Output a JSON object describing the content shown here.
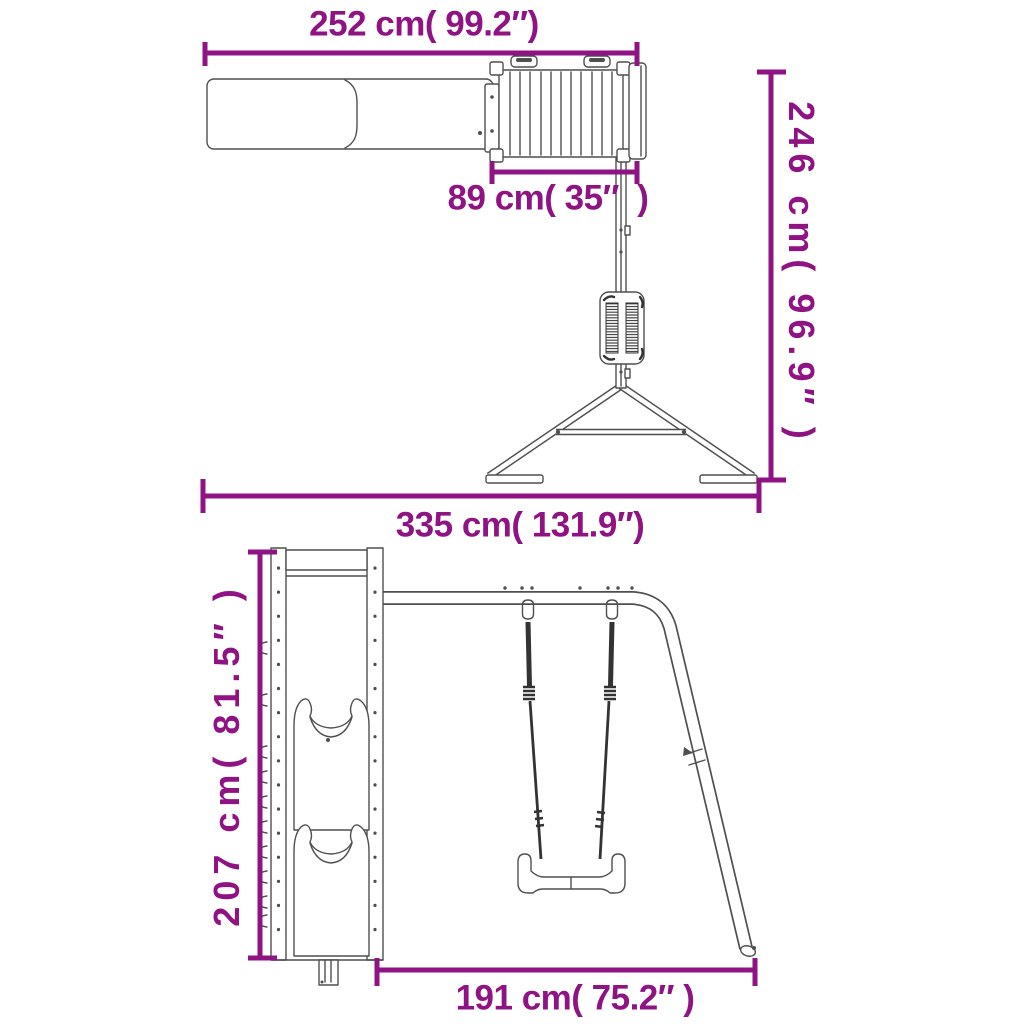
{
  "colors": {
    "dimension_accent": "#901384",
    "line_art": "#4F4F4F",
    "background": "#FFFFFF"
  },
  "views": {
    "top_view_dimensions": {
      "slide_platform_span": {
        "label": "252 cm( 99.2″)",
        "cm": 252,
        "inches": 99.2
      },
      "platform_width": {
        "label": "89 cm( 35″  )",
        "cm": 89,
        "inches": 35
      },
      "swing_frame_reach": {
        "label": "246 cm( 96.9″ )",
        "cm": 246,
        "inches": 96.9
      },
      "overall_span": {
        "label": "335 cm( 131.9″)",
        "cm": 335,
        "inches": 131.9
      }
    },
    "side_view_dimensions": {
      "tower_height": {
        "label": "207 cm( 81.5″ )",
        "cm": 207,
        "inches": 81.5
      },
      "swing_frame_depth": {
        "label": "191 cm( 75.2″ )",
        "cm": 191,
        "inches": 75.2
      }
    }
  }
}
